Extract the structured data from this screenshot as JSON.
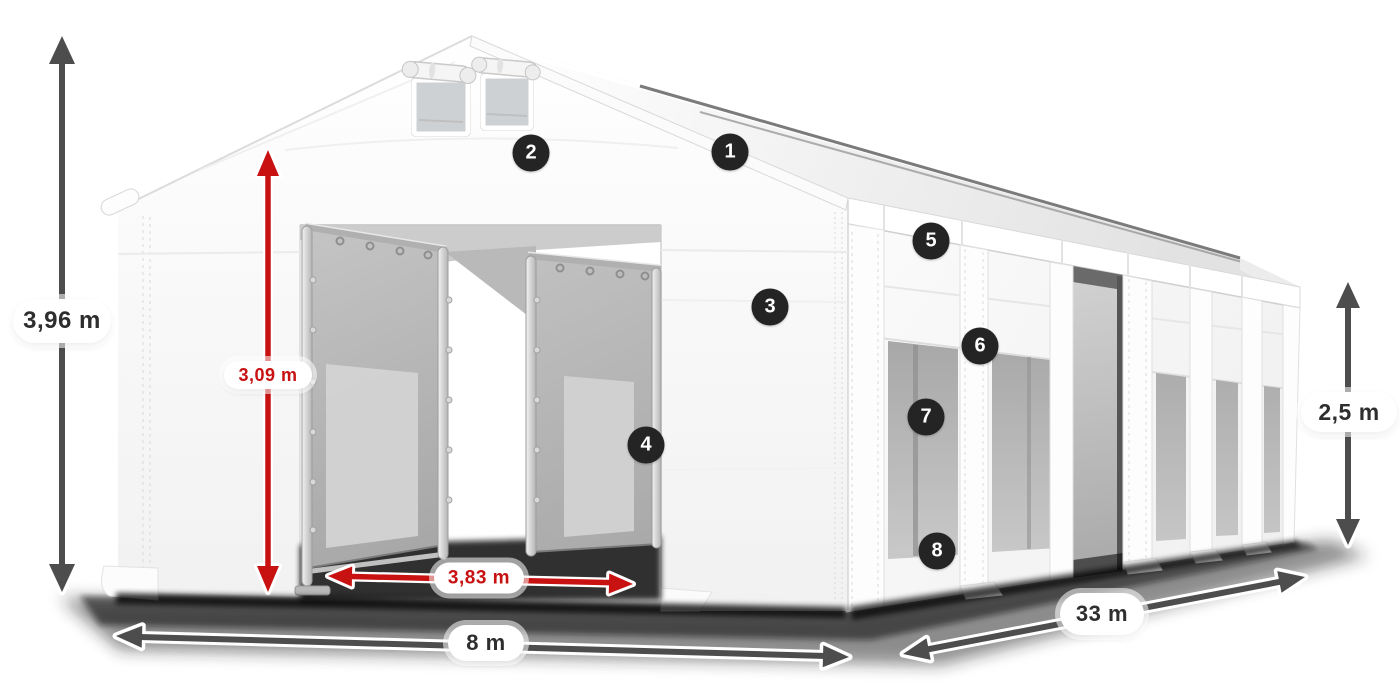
{
  "illustration": {
    "description": "White storage marquee tent product diagram with dimension arrows and numbered feature markers"
  },
  "dimensions": {
    "total_height": "3,96 m",
    "entrance_height": "3,09 m",
    "entrance_width": "3,83 m",
    "width": "8 m",
    "length": "33 m",
    "side_height": "2,5 m"
  },
  "badges": [
    {
      "number": "1"
    },
    {
      "number": "2"
    },
    {
      "number": "3"
    },
    {
      "number": "4"
    },
    {
      "number": "5"
    },
    {
      "number": "6"
    },
    {
      "number": "7"
    },
    {
      "number": "8"
    }
  ],
  "colors": {
    "dimension_red": "#c81212",
    "dimension_gray": "#4d4d4d",
    "badge_background": "#242424",
    "label_text": "#2e2e2e",
    "label_background": "#ffffff"
  }
}
